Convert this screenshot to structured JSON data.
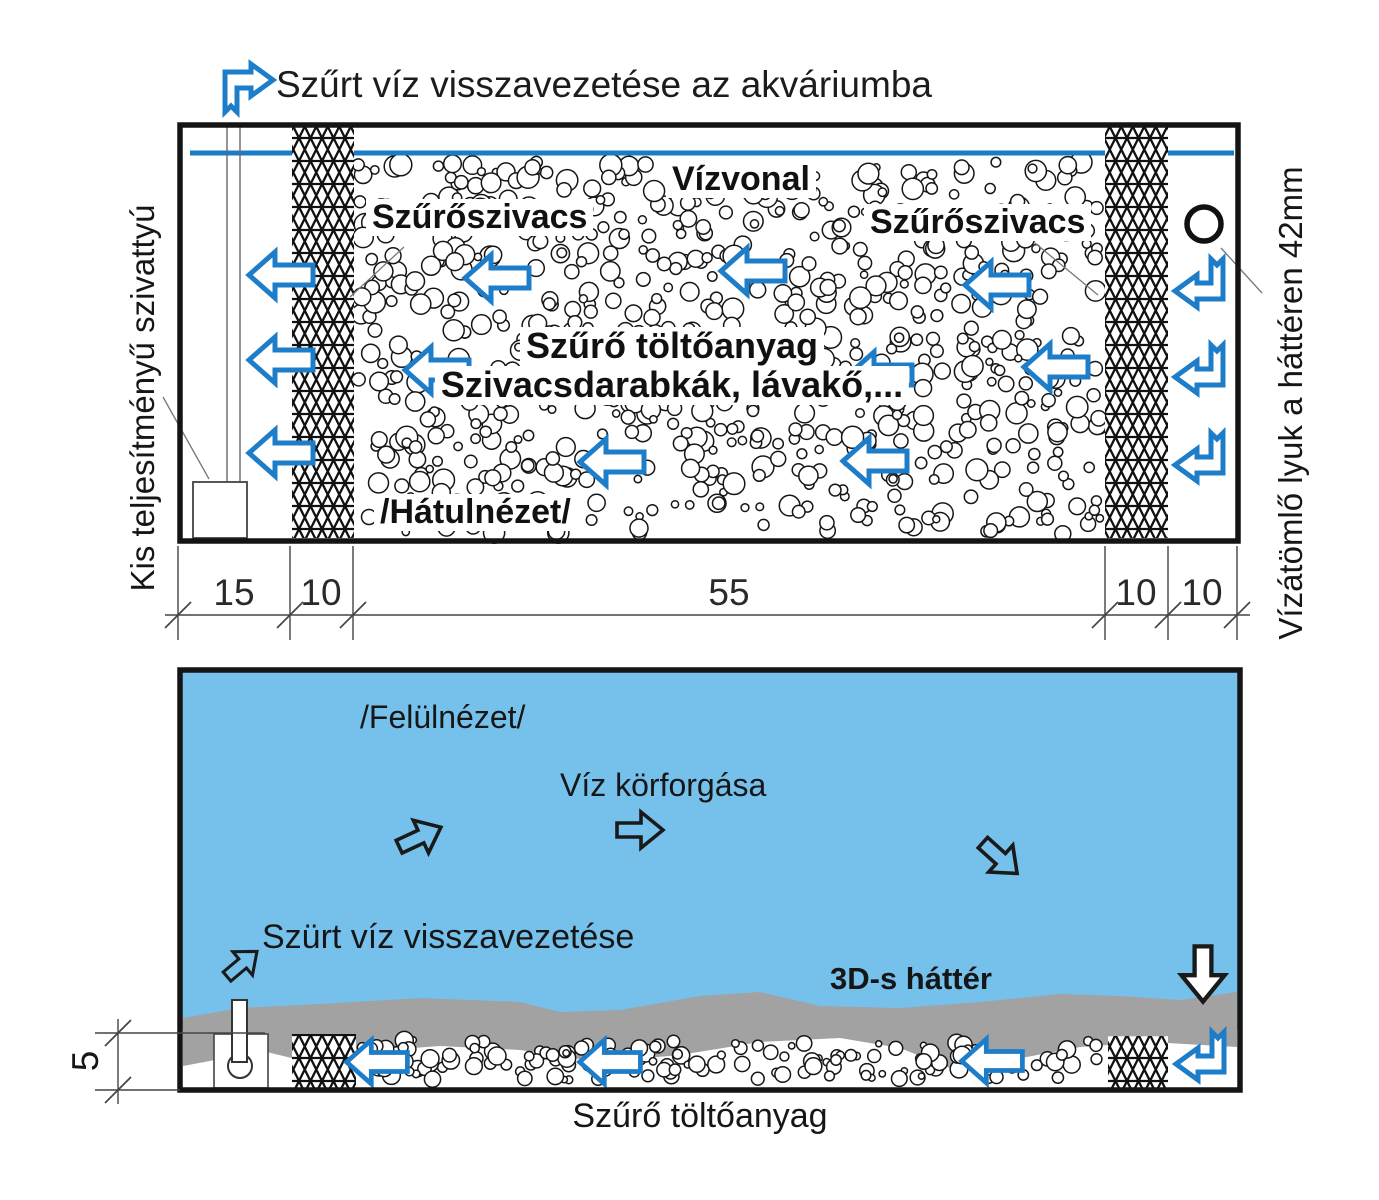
{
  "colors": {
    "water_fill": "#75c1ec",
    "water_line": "#1a7cc7",
    "flow_arrow_blue": "#1d7dc9",
    "background_3d_gray": "#a2a2a2",
    "ink": "#141414"
  },
  "top_label": {
    "text": "Szűrt víz visszavezetése az akváriumba"
  },
  "rear_view": {
    "left_vertical_label": "Kis teljesítményű szivattyú",
    "right_vertical_label": "Vízátömlő lyuk a háttéren 42mm",
    "water_line_label": "Vízvonal",
    "sponge_label_left": "Szűrőszivacs",
    "sponge_label_right": "Szűrőszivacs",
    "media_label_line1": "Szűrő töltőanyag",
    "media_label_line2": "Szivacsdarabkák, lávakő,...",
    "view_label": "/Hátulnézet/",
    "dimensions": [
      "15",
      "10",
      "55",
      "10",
      "10"
    ]
  },
  "top_view": {
    "view_label": "/Felülnézet/",
    "circulation_label": "Víz körforgása",
    "return_label": "Szürt víz visszavezetése",
    "background_label": "3D-s háttér",
    "media_label": "Szűrő töltőanyag",
    "depth_dimension": "5"
  }
}
